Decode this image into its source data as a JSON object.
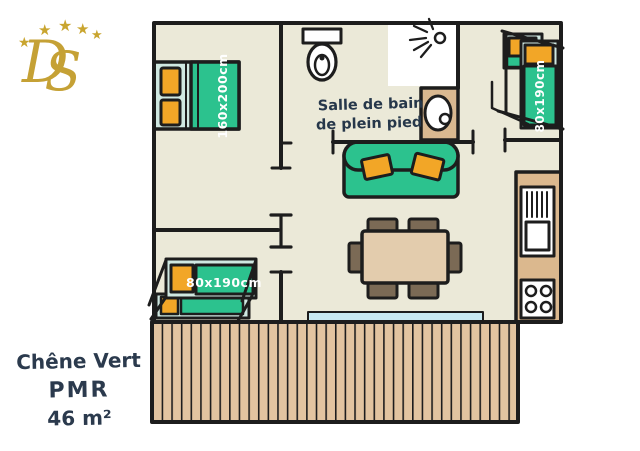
{
  "logo": {
    "monogram_d": "D",
    "monogram_s": "S",
    "star": "★",
    "star_count": 5,
    "gold": "#c5a135"
  },
  "caption": {
    "name": "Chêne Vert",
    "category": "PMR",
    "area": "46 m²"
  },
  "plan": {
    "bathroom_label_line1": "Salle de bain",
    "bathroom_label_line2": "de plein pied",
    "double_bed_size": "160x200cm",
    "bunk_right_size": "80x190cm",
    "bunk_left_size": "80x190cm"
  },
  "colors": {
    "floor": "#ebe9d8",
    "wall": "#1d1d1d",
    "mattress_green": "#2cc28e",
    "pillow_orange": "#f2a627",
    "bed_frame_teal": "#cfe8e1",
    "deck_tan": "#e2c4a0",
    "kitchen_counter": "#dbb88e",
    "basin_counter": "#d9b890",
    "table_tan": "#e3ccad",
    "chair_brown": "#7b6a55",
    "bay_window_blue": "#c8e9f2",
    "handwriting": "#2b3a4d"
  }
}
